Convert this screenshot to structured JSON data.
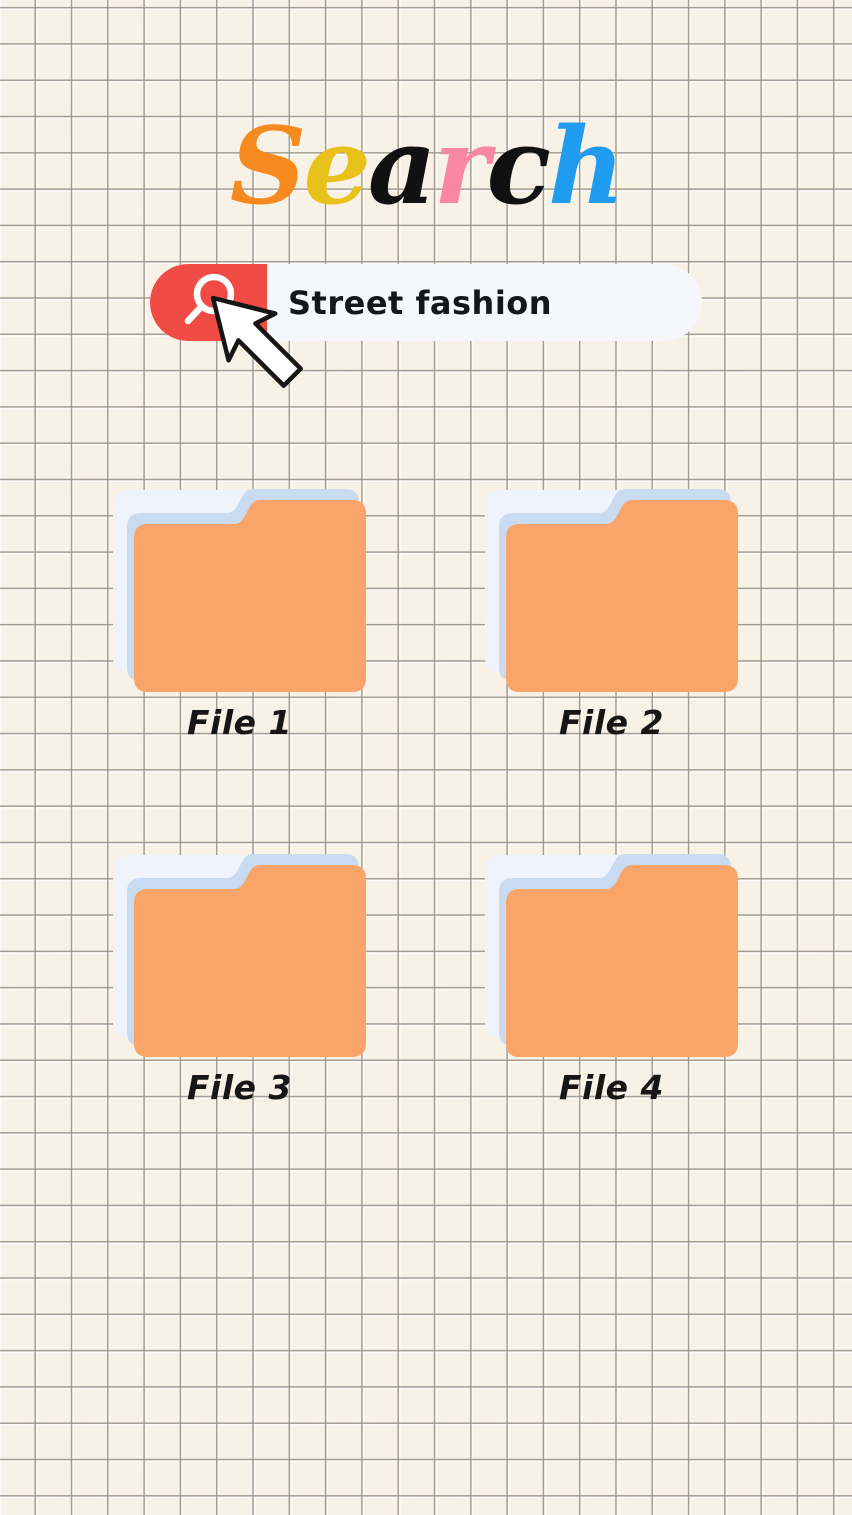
{
  "title": {
    "text": "Search",
    "letters": [
      {
        "char": "S",
        "color": "#F68A1F"
      },
      {
        "char": "e",
        "color": "#E8C11B"
      },
      {
        "char": "a",
        "color": "#111111"
      },
      {
        "char": "r",
        "color": "#F987A0"
      },
      {
        "char": "c",
        "color": "#111111"
      },
      {
        "char": "h",
        "color": "#1F9CEF"
      }
    ]
  },
  "search": {
    "query": "Street fashion",
    "button_color": "#F04B44",
    "bar_color": "#F5F7FD",
    "icon_color": "#FFFFFF"
  },
  "cursor": {
    "fill": "#FFFFFF",
    "outline": "#151515"
  },
  "folders": [
    {
      "label": "File 1"
    },
    {
      "label": "File 2"
    },
    {
      "label": "File 3"
    },
    {
      "label": "File 4"
    }
  ],
  "colors": {
    "background": "#F7F1E6",
    "grid_line": "#A9A399",
    "folder_front": "#F9A469",
    "folder_middle": "#C9DBF1",
    "folder_back": "#EFF4FC",
    "label_text": "#161616",
    "query_text": "#15151C"
  }
}
